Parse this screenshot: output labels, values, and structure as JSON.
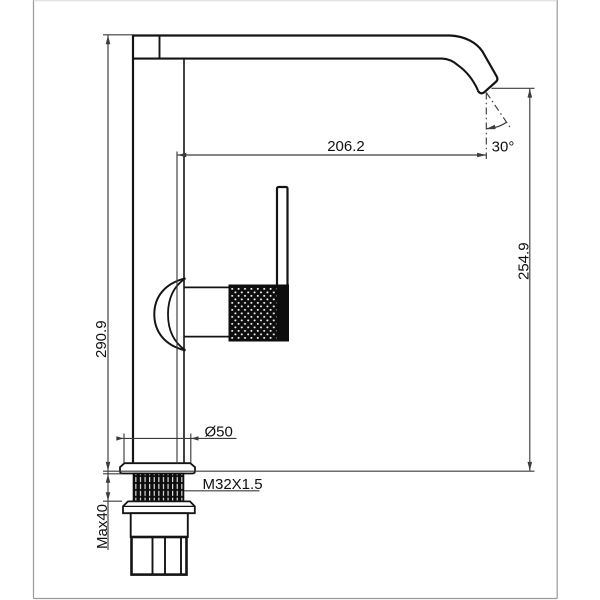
{
  "drawing": {
    "labels": {
      "spout_reach": "206.2",
      "spout_angle": "30°",
      "outlet_height": "254.9",
      "overall_height": "290.9",
      "base_diameter": "Ø50",
      "thread": "M32X1.5",
      "max_thickness": "Max40"
    },
    "colors": {
      "ink": "#141414",
      "dim": "#3c3c3c",
      "frame": "#9a9a9a",
      "bg": "#ffffff"
    }
  }
}
